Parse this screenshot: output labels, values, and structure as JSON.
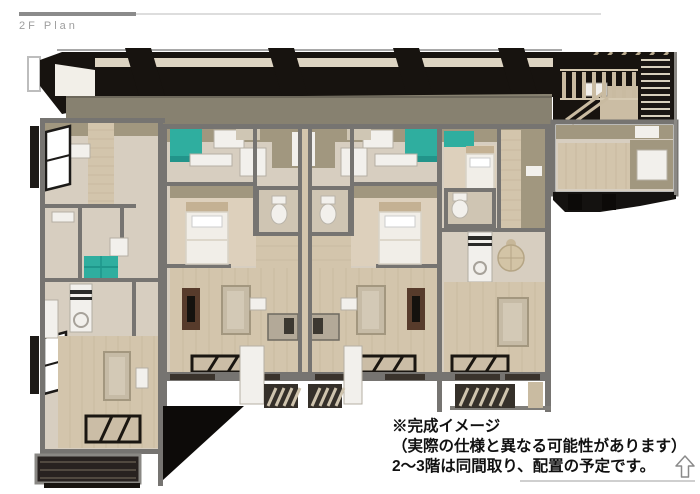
{
  "page": {
    "background": "#ffffff"
  },
  "header": {
    "title": "2F Plan",
    "title_color": "#9e9e9e",
    "bar_color_dark": "#8b8b8b",
    "bar_color_light": "#dddddd"
  },
  "caption": {
    "line1": "※完成イメージ",
    "line2": "（実際の仕様と異なる可能性があります）",
    "line3": "2～3階は同間取り、配置の予定です。",
    "color": "#111111"
  },
  "icons": {
    "cursor": "up-arrow-cursor-icon"
  },
  "floorplan": {
    "label": "2F furnished floor plan, 3D top-down render",
    "units": [
      "unit-left",
      "unit-b",
      "unit-c",
      "unit-d",
      "stair-wing"
    ],
    "features": [
      "beds",
      "sofas",
      "toilets",
      "kitchen-counters",
      "teal-cabinets",
      "entrance-mats",
      "balconies",
      "exterior-stairs",
      "roof-beams"
    ],
    "palette": {
      "wall_gray": "#767471",
      "wall_taupe": "#a1977f",
      "floor_beige": "#d7cec0",
      "floor_wood": "#d3c5ac",
      "accent_teal": "#2fae9f",
      "fixture_white": "#f2f0ec",
      "roof_black": "#17130f",
      "eave_olive": "#878170",
      "tv_board_brown": "#573b2b",
      "balcony_dark": "#282220"
    }
  }
}
